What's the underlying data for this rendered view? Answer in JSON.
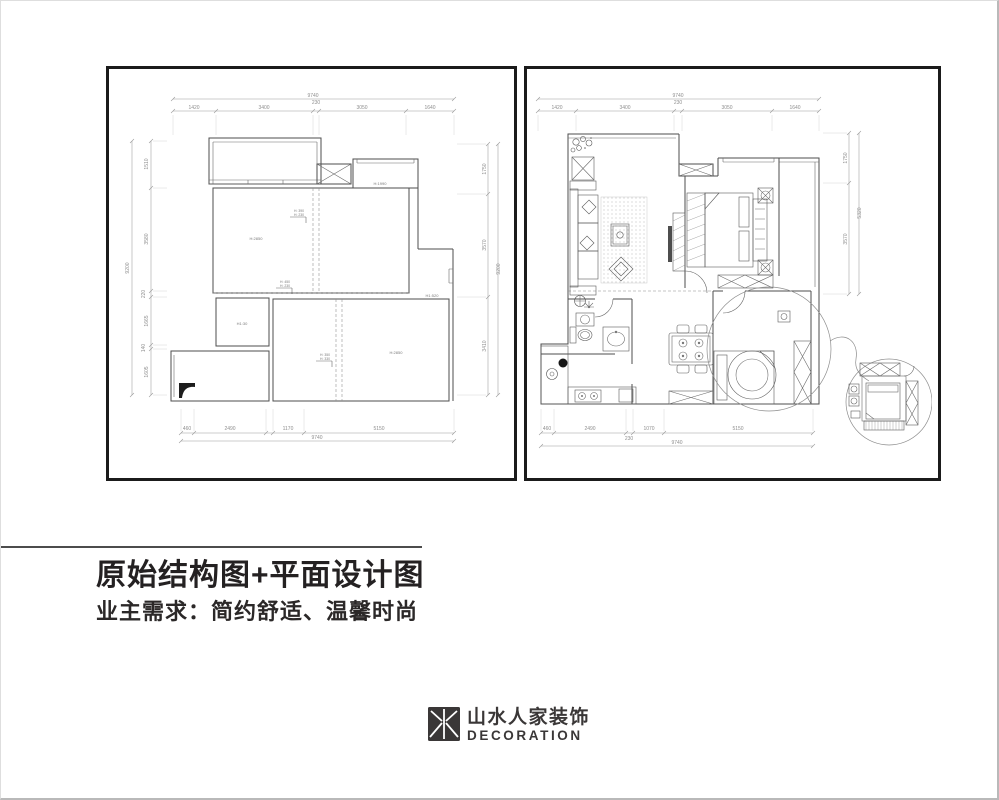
{
  "page": {
    "title": "原始结构图+平面设计图",
    "subtitle": "业主需求：简约舒适、温馨时尚",
    "colors": {
      "wall_line": "#4d4d4d",
      "dim_text": "#8f8f8f",
      "panel_border": "#1b1b1b",
      "title_text": "#242122",
      "logo": "#3a3737"
    }
  },
  "logo": {
    "name": "山水人家装饰",
    "subname": "DECORATION"
  },
  "left_plan": {
    "dims": {
      "top_total": "9740",
      "top": [
        "1420",
        "3400",
        "230",
        "3050",
        "1640"
      ],
      "left_total": "9200",
      "left": [
        "1510",
        "3580",
        "220",
        "1665",
        "140",
        "1605"
      ],
      "right_total": "9200",
      "right": [
        "1750",
        "3570",
        "3410"
      ],
      "bottom": [
        "460",
        "2490",
        "1170",
        "5150"
      ],
      "bottom_total": "9740"
    },
    "labels": {
      "storage_height": "H:1990",
      "beam_a1": "H: 390",
      "beam_a2": "H: 230",
      "beam_b1": "H: 450",
      "beam_b2": "H: 230",
      "beam_c1": "H: 350",
      "beam_c2": "H: 330",
      "living_height": "H:2850",
      "window_height": "H1:520",
      "bath_height": "H1:30",
      "bedroom_height": "H:2850"
    }
  },
  "right_plan": {
    "dims": {
      "top_total": "9740",
      "top": [
        "1420",
        "3400",
        "230",
        "3050",
        "1640"
      ],
      "right_total": "5320",
      "right": [
        "1750",
        "3570"
      ],
      "bottom": [
        "460",
        "2490",
        "230",
        "1070",
        "5150"
      ],
      "bottom_total": "9740"
    }
  }
}
